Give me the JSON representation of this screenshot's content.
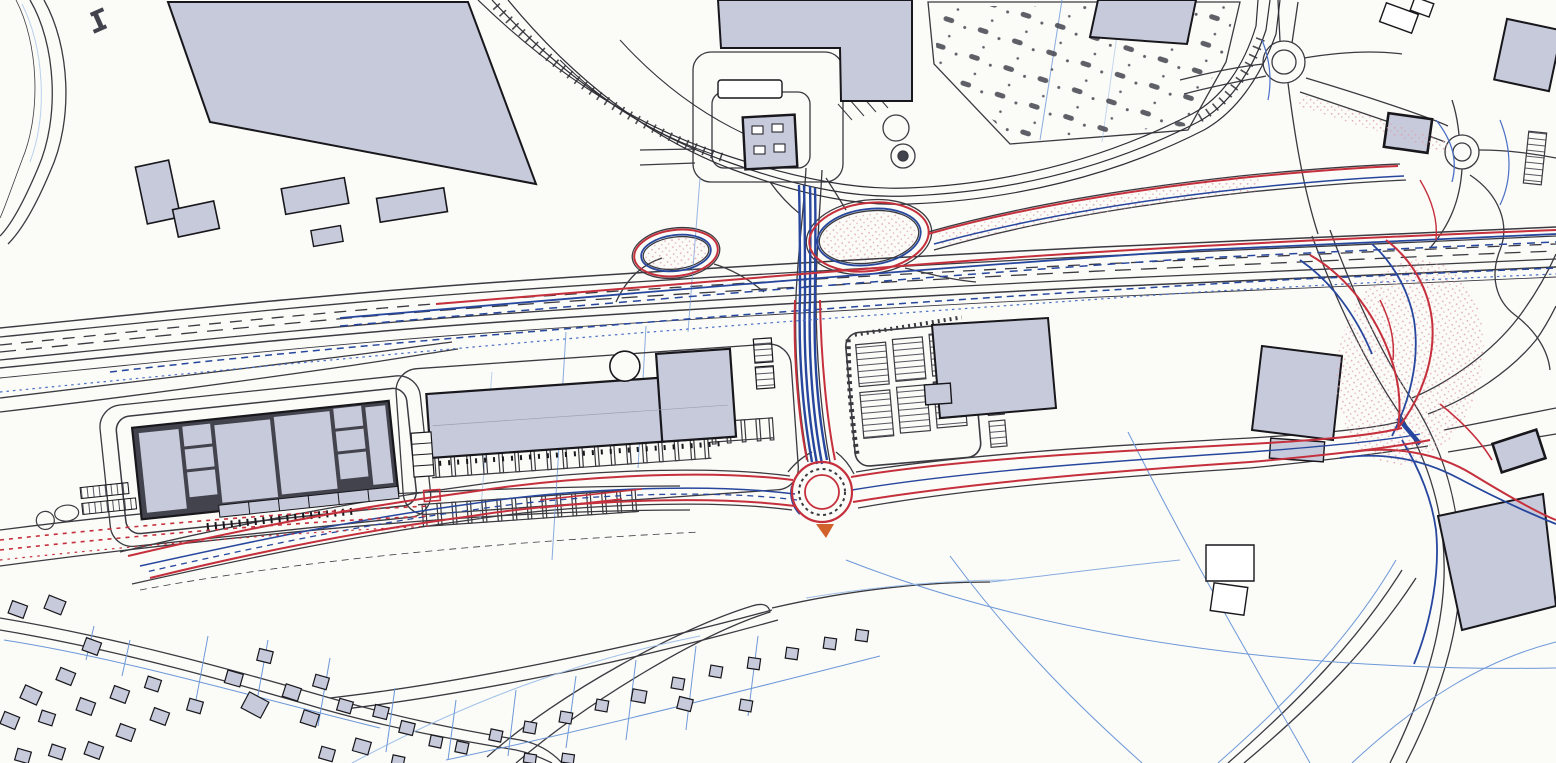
{
  "drawing": {
    "description": "Scanned engineering site plan: proposed highway junction and link road scheme (red/blue pen overlay) on a black-line base map with retail and warehouse buildings, parking areas, railway sidings and housing",
    "counts": {
      "roundabouts": 3,
      "houses_small": 46,
      "parking_teeth_main_row": 18,
      "parking_modules_east_block": 6
    }
  },
  "colors": {
    "paper": "#fbfbf8",
    "base_line": "#3a3a40",
    "base_light": "#8a8a92",
    "building_fill": "#c7cada",
    "building_outline": "#17171c",
    "frame_dark": "#43434e",
    "scheme_red": "#c5303c",
    "splitter_orange": "#d2622c",
    "scheme_blue": "#27479e",
    "scheme_blue_light": "#4a6fc4",
    "parcel_blue": "#6d98d8",
    "parcel_blue_light": "#9fc0e8",
    "stipple_pink": "#de9daa",
    "rail_dark": "#2f2f36"
  },
  "features": [
    {
      "id": "bypass-carriageway",
      "label": "main east-west dual carriageway"
    },
    {
      "id": "loop-ramps",
      "label": "slip road loops at central junction"
    },
    {
      "id": "link-road",
      "label": "north-south link road (blue overlay)"
    },
    {
      "id": "main-roundabout",
      "label": "proposed roundabout (red overlay)"
    },
    {
      "id": "east-junction",
      "label": "complex junction with red/blue overlay, east side"
    },
    {
      "id": "ne-roundabout",
      "label": "small roundabout, top right"
    },
    {
      "id": "east-roundabout",
      "label": "small roundabout near petrol building, far right"
    },
    {
      "id": "railway-sidings",
      "label": "railway lines and sidings, top left to top right"
    },
    {
      "id": "warehouse-complex",
      "label": "large subdivided warehouse building, centre left"
    },
    {
      "id": "retail-building",
      "label": "long retail building with circular feature, centre"
    },
    {
      "id": "gas-station",
      "label": "petrol filling station with pump islands, top centre"
    },
    {
      "id": "parking-areas",
      "label": "car parking rows and landscaped car park"
    },
    {
      "id": "housing",
      "label": "residential plots and houses, bottom left"
    },
    {
      "id": "field-parcels",
      "label": "blue parcel / field boundary lines, bottom right"
    }
  ]
}
